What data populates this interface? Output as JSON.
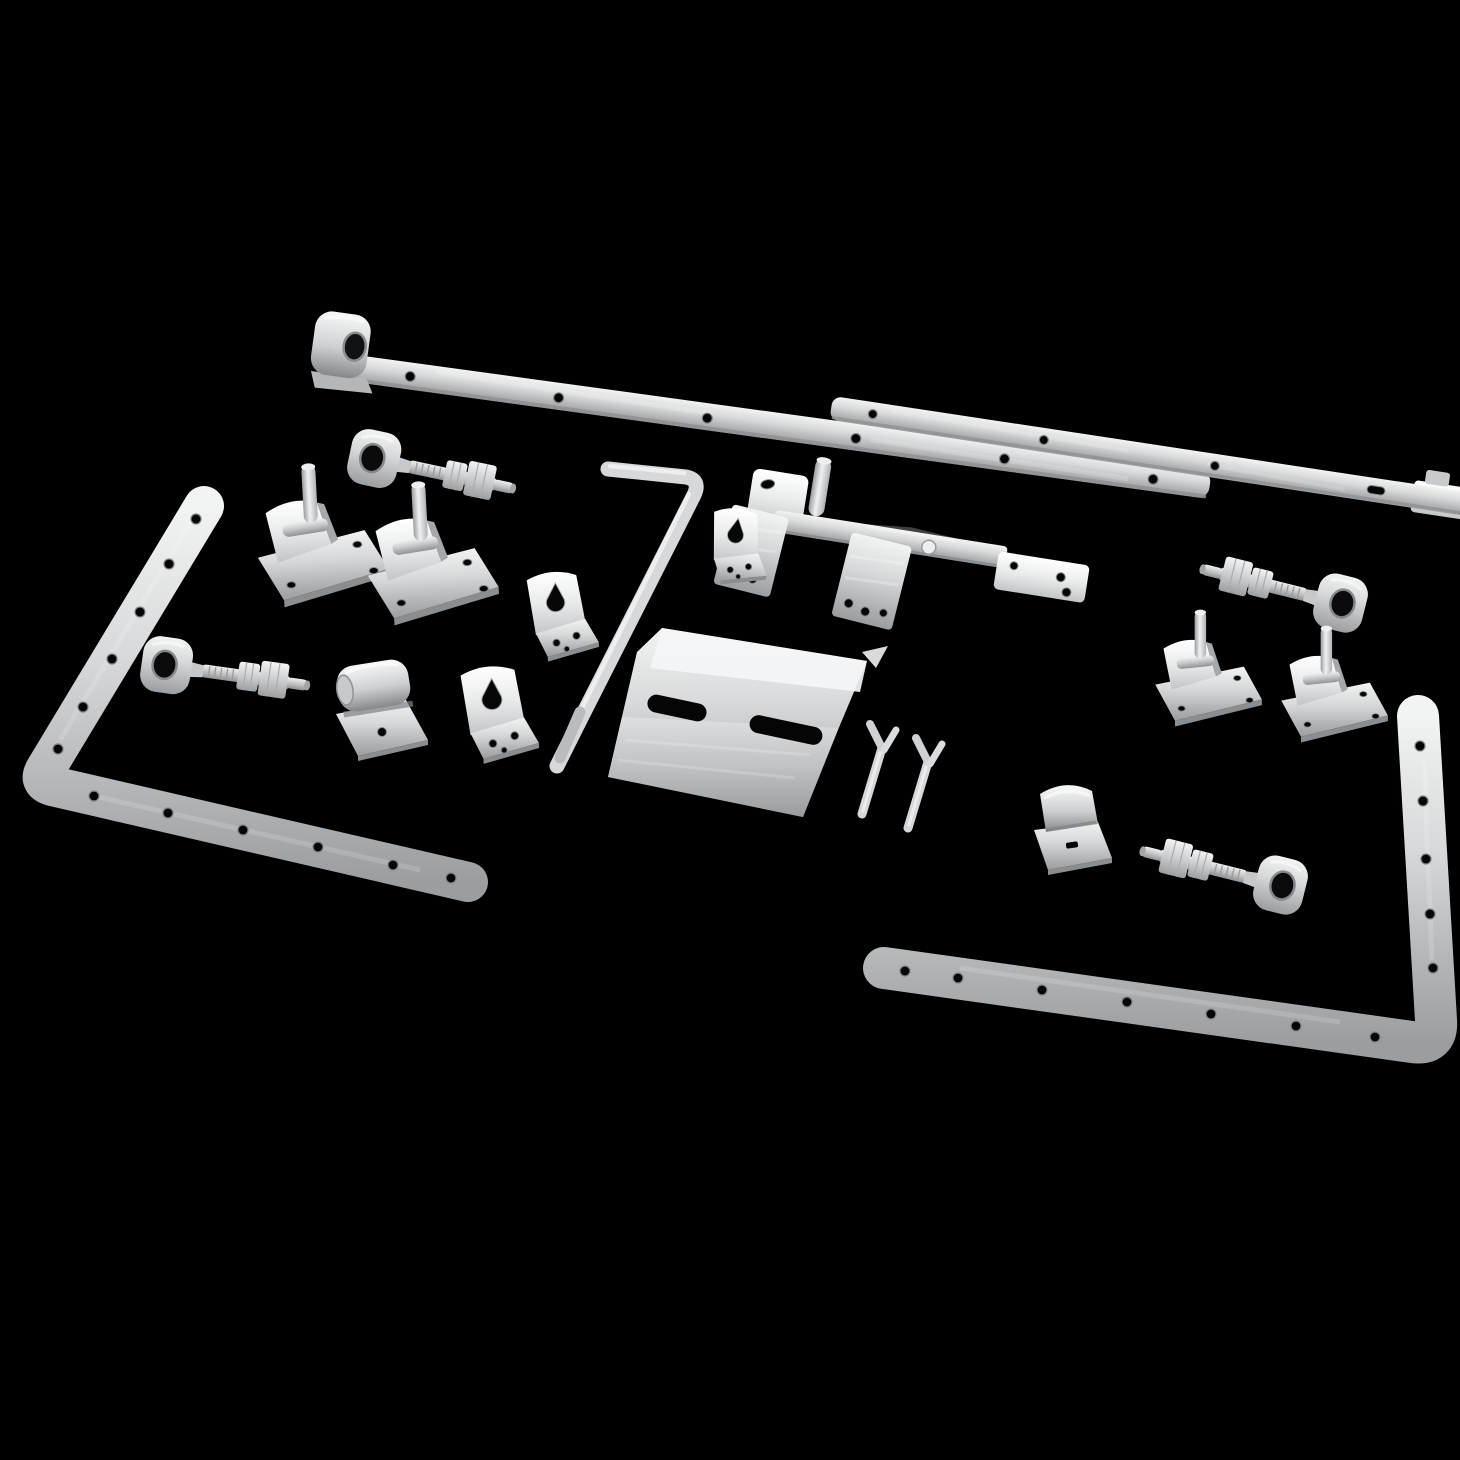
{
  "scene": {
    "description": "Product photograph: hot-dip galvanised steel field-gate ironmongery kit (hinge bands, hooks on plates, adjustable eye bolts, latch parts, drop bolt, guide brackets and cotter pins) arranged diagonally on a plain black background",
    "background_color": "#000000",
    "finish": "galvanised silver",
    "item_count": 24,
    "metal_colors": {
      "highlight": "#f5f6f6",
      "mid": "#cfd2d3",
      "shadow": "#8e9193"
    }
  },
  "parts": [
    {
      "id": "hinge-band-top",
      "label": "Gate hinge band with rolled eye, drilled",
      "type": "strap-hinge"
    },
    {
      "id": "gate-band-upper-right",
      "label": "Gate band strap with slot, drilled",
      "type": "strap"
    },
    {
      "id": "spring-latch-assembly",
      "label": "Gate latch slide bar with striker pin plate",
      "type": "latch"
    },
    {
      "id": "keeper-plate-a",
      "label": "Latch keeper plate",
      "type": "plate"
    },
    {
      "id": "keeper-plate-b",
      "label": "Latch keeper plate",
      "type": "plate"
    },
    {
      "id": "eye-bolt-top-left",
      "label": "Adjustable gate eye bolt with two hex nuts",
      "type": "eye-bolt"
    },
    {
      "id": "eye-bolt-mid-left",
      "label": "Adjustable gate eye bolt with two hex nuts",
      "type": "eye-bolt"
    },
    {
      "id": "eye-bolt-right",
      "label": "Adjustable gate eye bolt with two hex nuts",
      "type": "eye-bolt"
    },
    {
      "id": "eye-bolt-bottom-right",
      "label": "Adjustable gate eye bolt with two hex nuts",
      "type": "eye-bolt"
    },
    {
      "id": "hook-on-plate-1",
      "label": "Gate hook pin on square plate",
      "type": "hinge-pin"
    },
    {
      "id": "hook-on-plate-2",
      "label": "Gate hook pin on square plate",
      "type": "hinge-pin"
    },
    {
      "id": "hook-on-plate-3",
      "label": "Gate hook pin on square plate",
      "type": "hinge-pin"
    },
    {
      "id": "hook-on-plate-4",
      "label": "Gate hook pin on square plate",
      "type": "hinge-pin"
    },
    {
      "id": "corner-band-left",
      "label": "L-shaped corner hinge band, drilled",
      "type": "corner-strap"
    },
    {
      "id": "corner-band-right",
      "label": "L-shaped corner hinge band, drilled",
      "type": "corner-strap"
    },
    {
      "id": "drop-bolt-rod",
      "label": "Gate drop bolt rod with L handle",
      "type": "rod"
    },
    {
      "id": "guide-bracket-1",
      "label": "Drop bolt guide bracket with keyhole slot",
      "type": "bracket"
    },
    {
      "id": "guide-bracket-2",
      "label": "Drop bolt guide bracket with keyhole slot",
      "type": "bracket"
    },
    {
      "id": "guide-bracket-3",
      "label": "Drop bolt guide bracket with keyhole slot",
      "type": "bracket"
    },
    {
      "id": "rolled-keeper",
      "label": "Rolled latch keeper bracket",
      "type": "bracket"
    },
    {
      "id": "saddle-clamp",
      "label": "Saddle clamp bracket with slot",
      "type": "bracket"
    },
    {
      "id": "catch-plate",
      "label": "Bent latch catch plate with two slotted holes",
      "type": "plate"
    },
    {
      "id": "split-pin-1",
      "label": "Split cotter pin",
      "type": "pin"
    },
    {
      "id": "split-pin-2",
      "label": "Split cotter pin",
      "type": "pin"
    }
  ]
}
